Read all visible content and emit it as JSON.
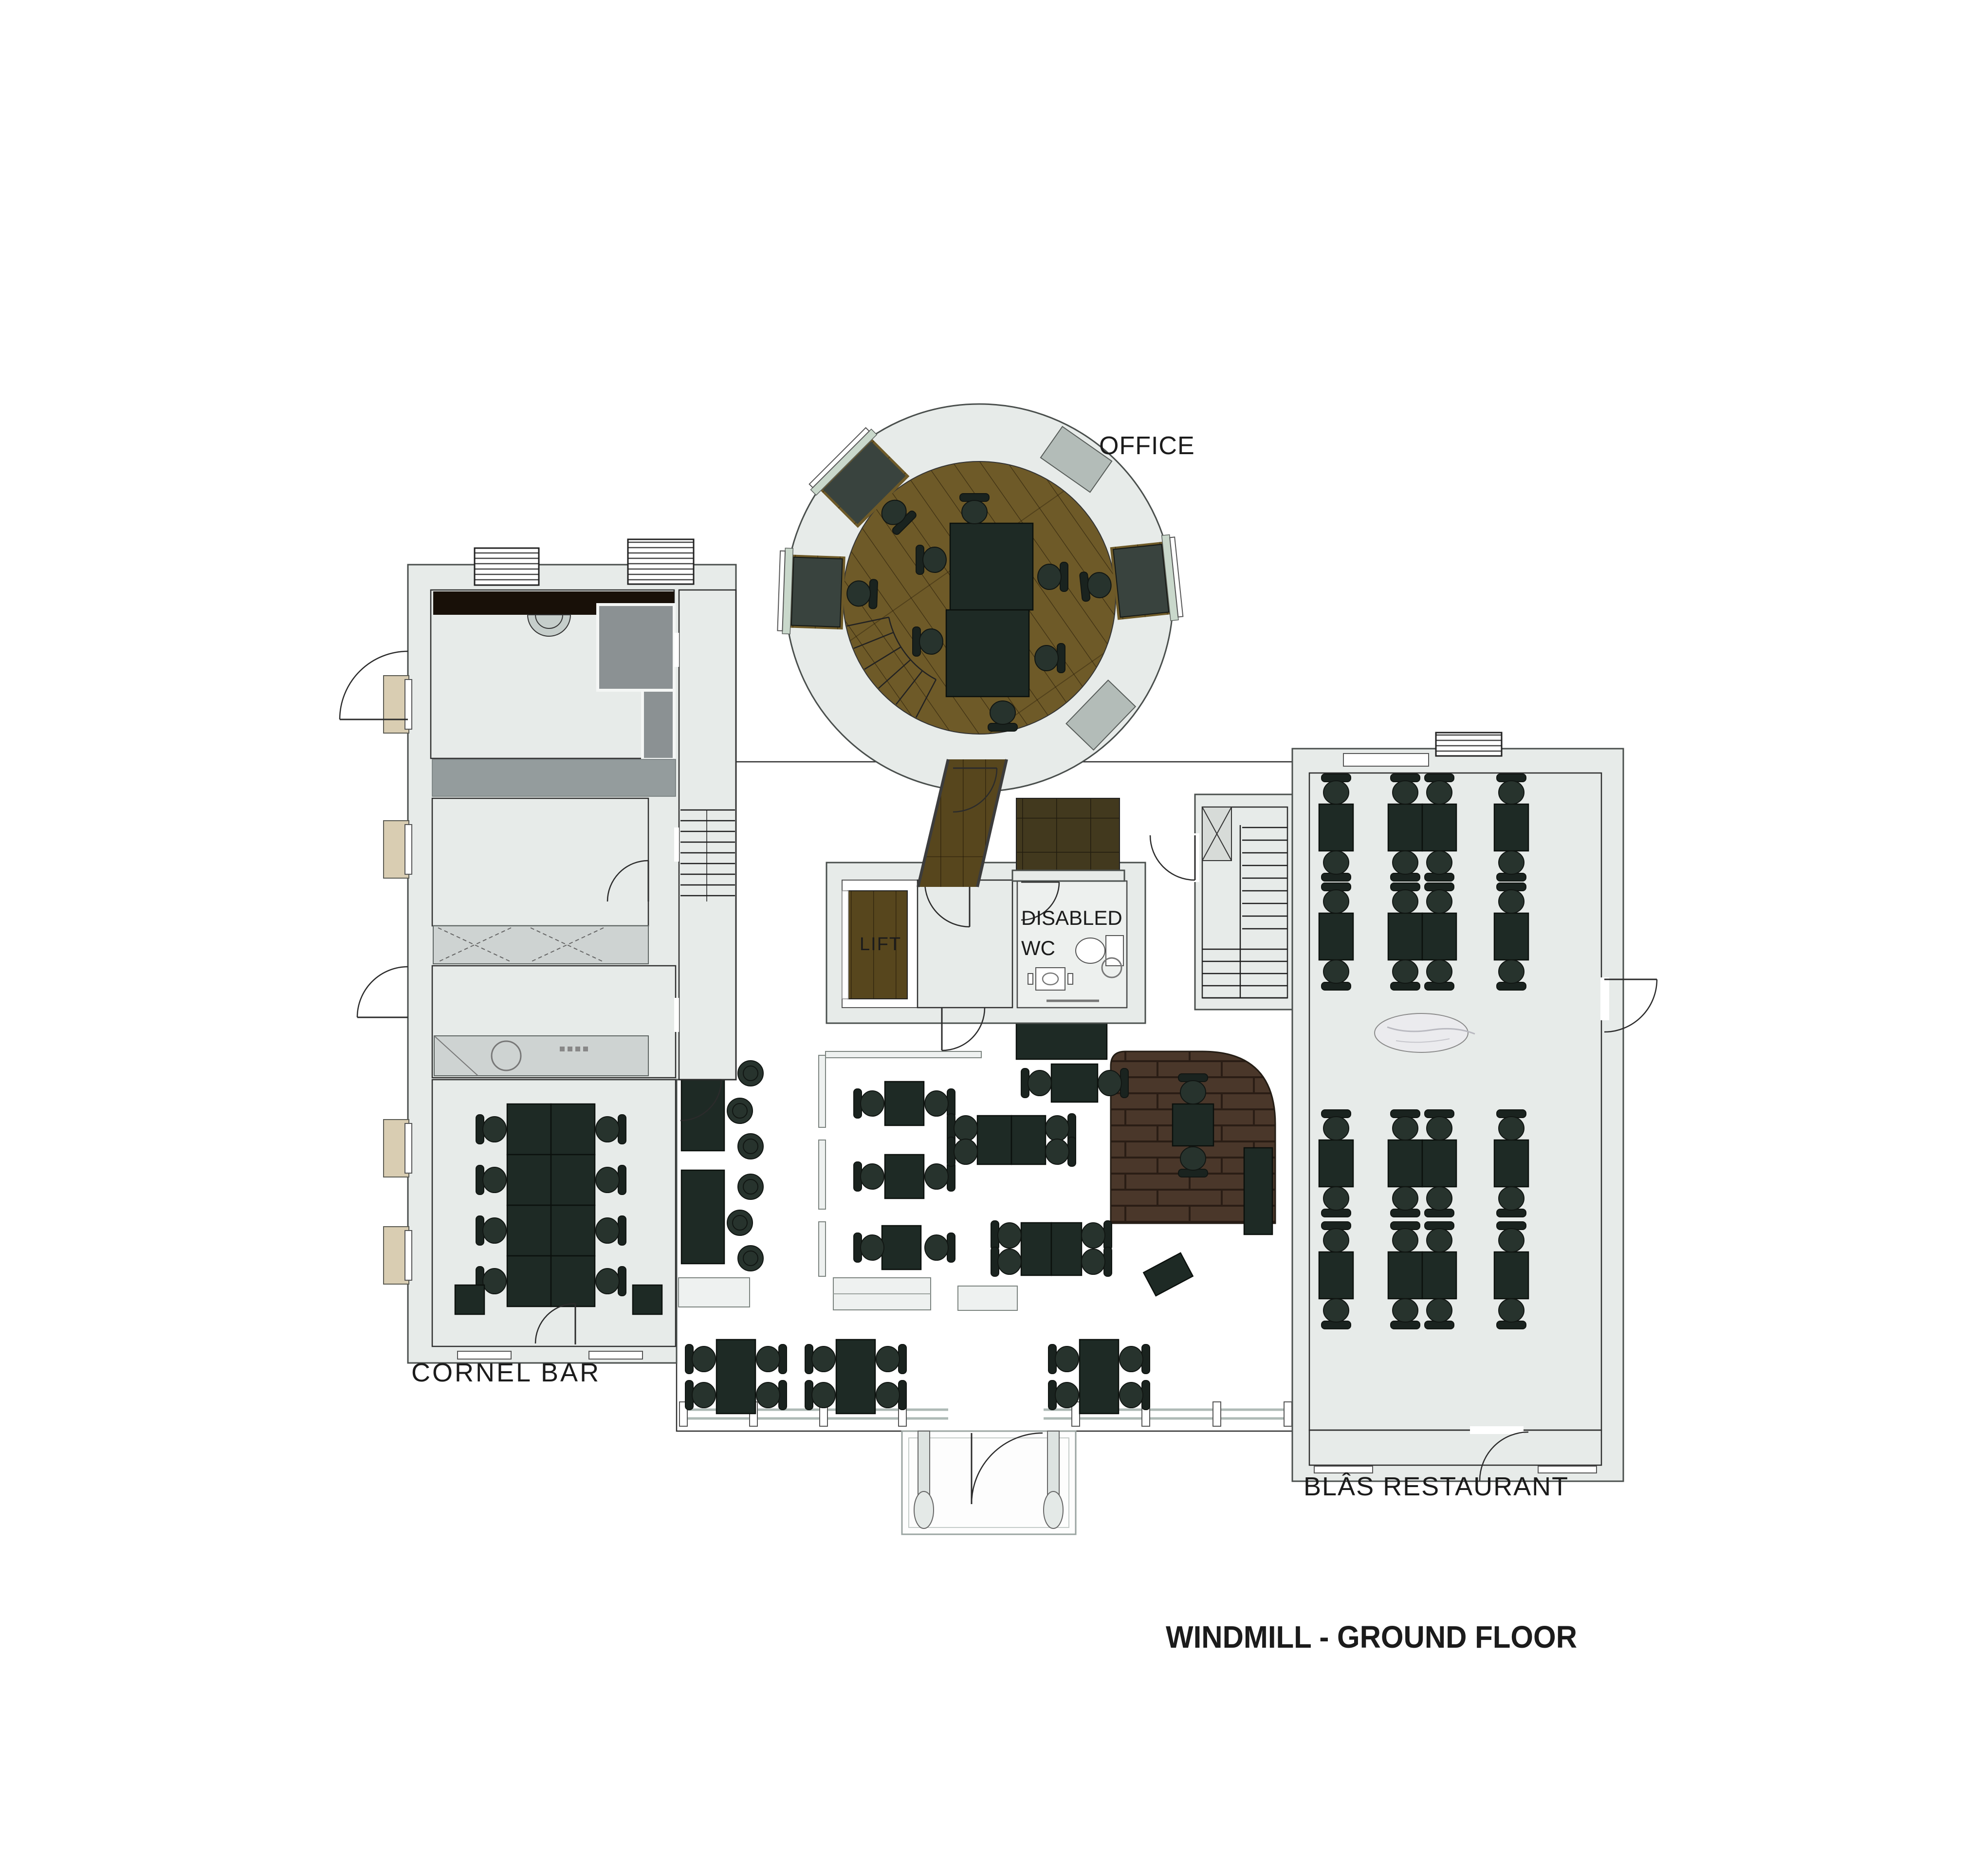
{
  "labels": {
    "title": "WINDMILL - GROUND FLOOR",
    "office": "OFFICE",
    "disabled_wc_line1": "DISABLED",
    "disabled_wc_line2": "WC",
    "lift": "LIFT",
    "cornel_bar": "CORNEL BAR",
    "blas_restaurant": "BLÂS RESTAURANT"
  },
  "rooms": [
    {
      "name": "Office",
      "floor": "wood (round windmill tower)"
    },
    {
      "name": "Cornel Bar",
      "floor": "wood"
    },
    {
      "name": "Blâs Restaurant",
      "floor": "wood"
    },
    {
      "name": "Main dining hall",
      "floor": "stone flags"
    },
    {
      "name": "Disabled WC",
      "floor": "stone"
    },
    {
      "name": "Lift",
      "floor": "wood"
    },
    {
      "name": "Kitchen",
      "floor": "speckled screed"
    }
  ],
  "palette": {
    "wall": "#e7ebe9",
    "wood": "#6e5a28",
    "wood-dark": "#57461d",
    "stone": "#cdd1b3",
    "stone-line": "#8f957c",
    "platform": "#4a372a",
    "platform-line": "#2a1d15",
    "kitchen": "#b6aca1",
    "gray-room": "#8b9193",
    "table": "#1e2a25",
    "chair": "#27332d",
    "bench": "#eef1f0",
    "glass": "#c9d8cb",
    "beige": "#d9cdb2"
  }
}
